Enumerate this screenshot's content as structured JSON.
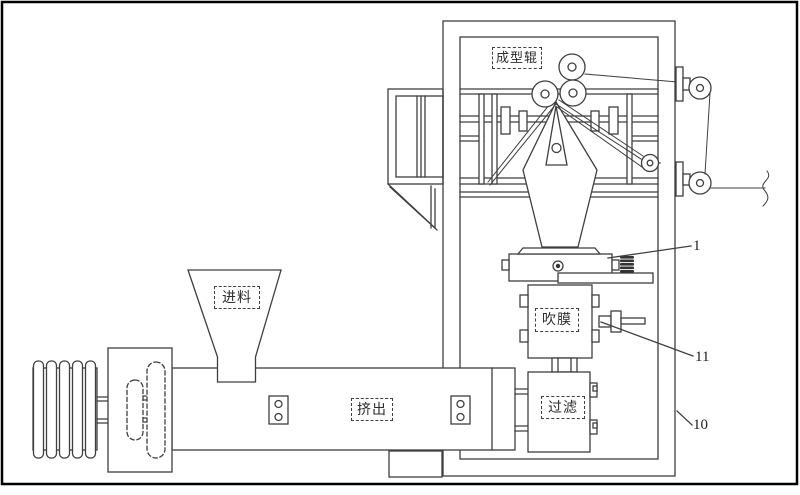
{
  "figure": {
    "type": "patent line drawing — blown-film extrusion machine",
    "background_color": "#ffffff",
    "line_color": "#3f3f3f",
    "border_color": "#000000",
    "component_labels": {
      "forming_roller": "成型辊",
      "feeding": "进料",
      "extrusion": "挤出",
      "film_blowing": "吹膜",
      "filtering": "过滤"
    },
    "reference_numerals": {
      "die_assembly": "1",
      "air_valve": "11",
      "machine_frame": "10"
    }
  }
}
